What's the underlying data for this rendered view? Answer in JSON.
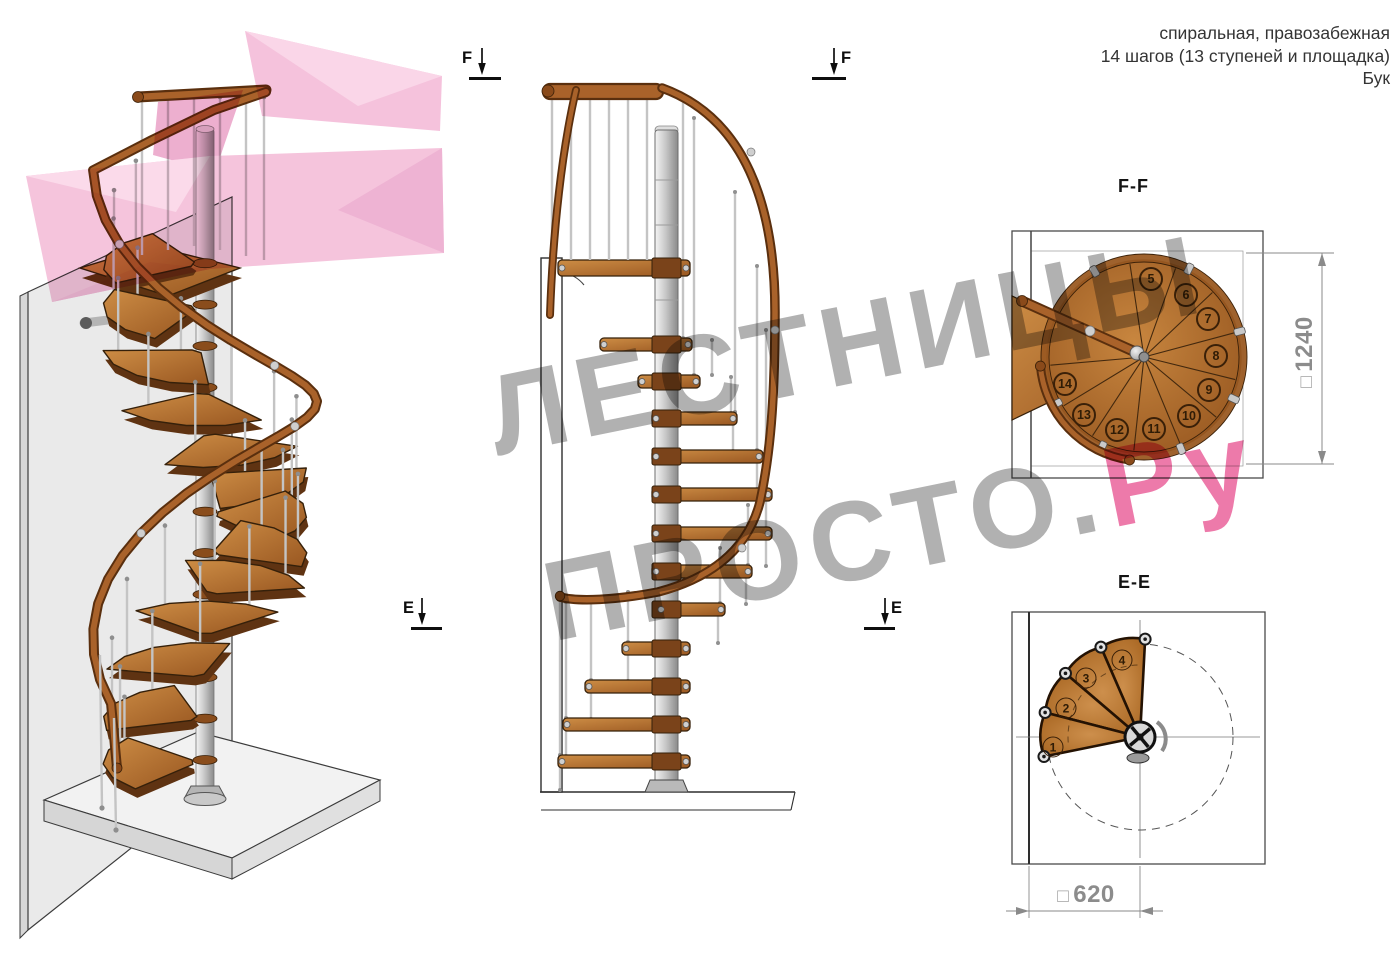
{
  "header": {
    "line1": "спиральная, правозабежная",
    "line2": "14 шагов (13 ступеней и площадка)",
    "line3": "Бук"
  },
  "titles": {
    "ff": "F-F",
    "ee": "E-E"
  },
  "markers": {
    "f": "F",
    "e": "E"
  },
  "dimensions": {
    "square_symbol": "□",
    "ff_value": "1240",
    "ee_value": "620"
  },
  "watermark": {
    "line1": "ЛЕСТНИЦЫ",
    "line2_gray": "ПРОСТО.",
    "line2_pink": "Ру"
  },
  "ff_step_numbers": [
    "5",
    "6",
    "7",
    "8",
    "9",
    "10",
    "11",
    "12",
    "13",
    "14"
  ],
  "ee_step_numbers": [
    "1",
    "2",
    "3",
    "4"
  ],
  "colors": {
    "wood": "#b06a2a",
    "wood_dark": "#5a2f0e",
    "metal": "#c9c9c9",
    "watermark_gray": "#979797",
    "watermark_pink": "#e75a92",
    "logo_pink": "#f3bad8",
    "dimension_gray": "#8c8c8c"
  }
}
